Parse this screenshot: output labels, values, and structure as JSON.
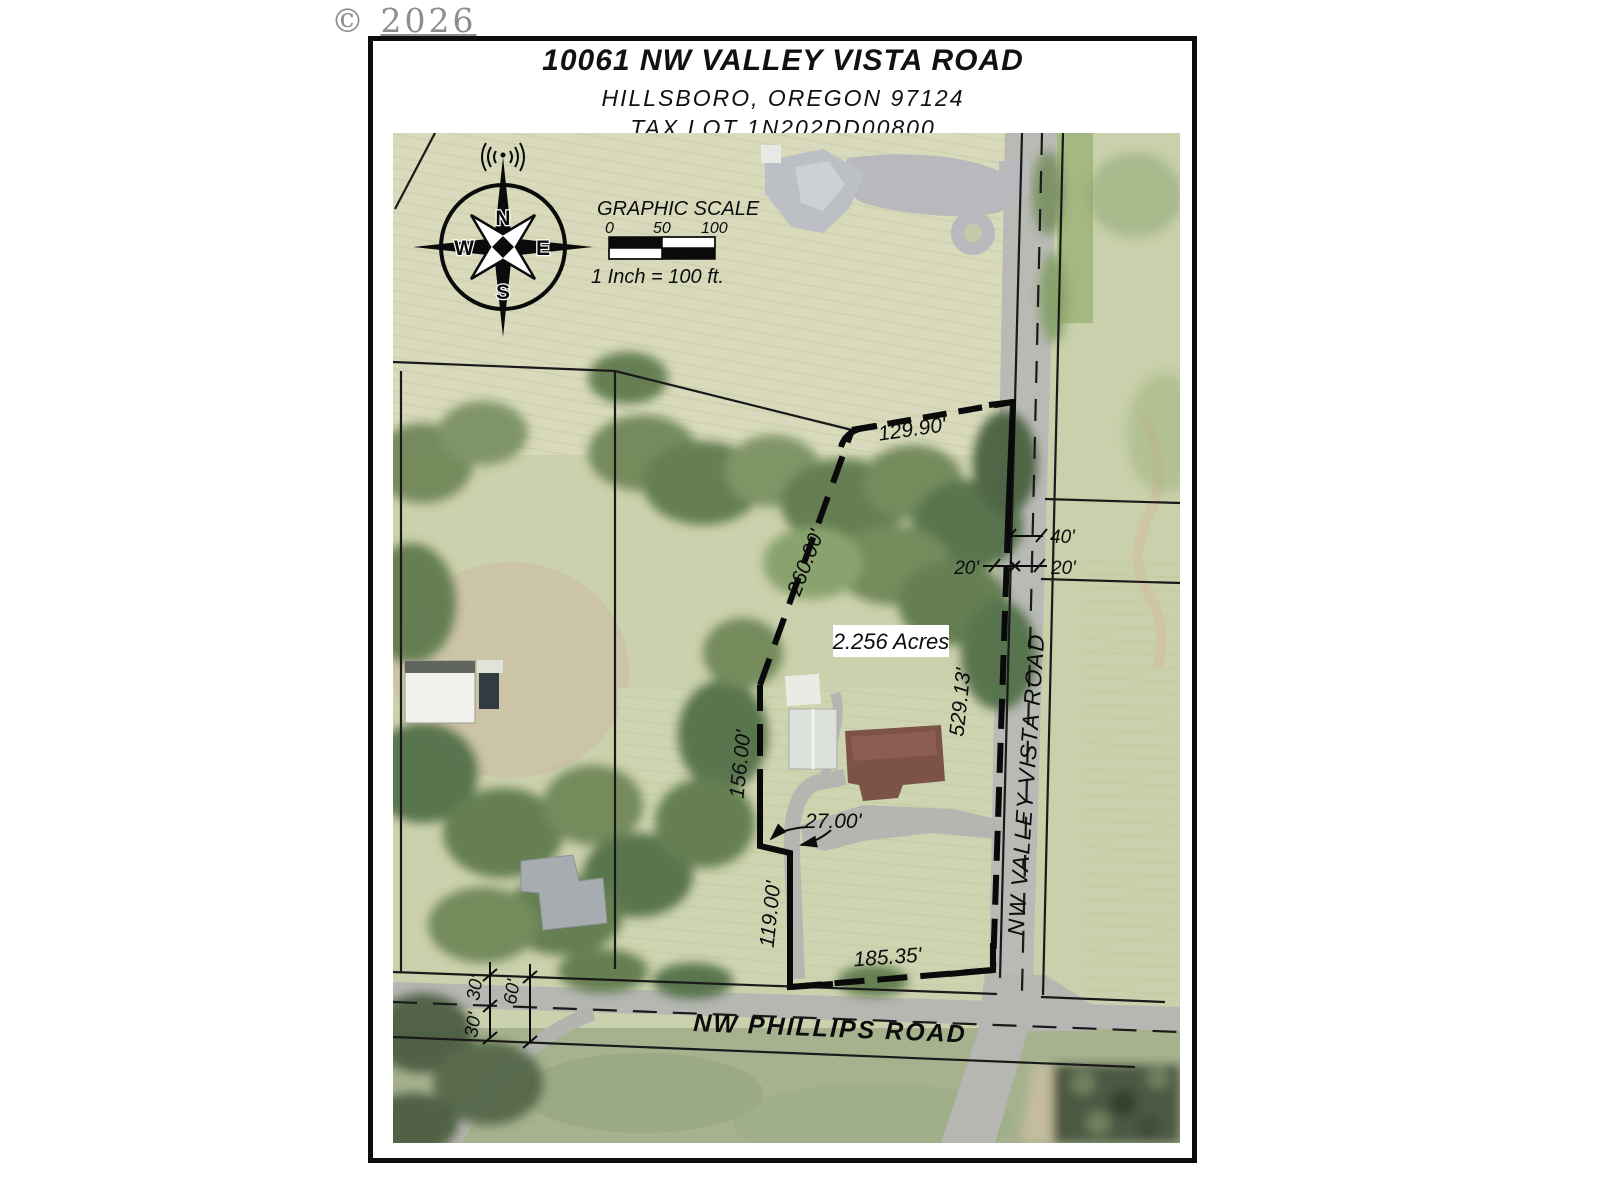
{
  "watermark": {
    "copyright": "©",
    "year": "2026"
  },
  "title_block": {
    "address": "10061 NW VALLEY VISTA ROAD",
    "city": "HILLSBORO,  OREGON  97124",
    "tax_lot": "TAX LOT 1N202DD00800"
  },
  "compass": {
    "n": "N",
    "e": "E",
    "s": "S",
    "w": "W"
  },
  "scale": {
    "title": "GRAPHIC SCALE",
    "tick0": "0",
    "tick50": "50",
    "tick100": "100",
    "caption": "1 Inch = 100 ft."
  },
  "parcel": {
    "area": "2.256 Acres",
    "dim_north": "129.90'",
    "dim_northwest": "260.00'",
    "dim_east": "529.13'",
    "dim_west_upper": "156.00'",
    "dim_jog": "27.00'",
    "dim_west_lower": "119.00'",
    "dim_south": "185.35'"
  },
  "road_dims": {
    "valley_vista_40": "40'",
    "valley_vista_20_west": "20'",
    "valley_vista_20_east": "20'",
    "phillips_30_north": "30'",
    "phillips_60": "60'",
    "phillips_30_south": "30'"
  },
  "roads": {
    "valley_vista": "NW VALLEY VISTA ROAD",
    "phillips": "NW PHILLIPS ROAD"
  },
  "palette": {
    "ink": "#0d0d0d",
    "field": "#d8dabb",
    "trees": "#5e7a4e",
    "pavement": "#b6b7b2"
  }
}
